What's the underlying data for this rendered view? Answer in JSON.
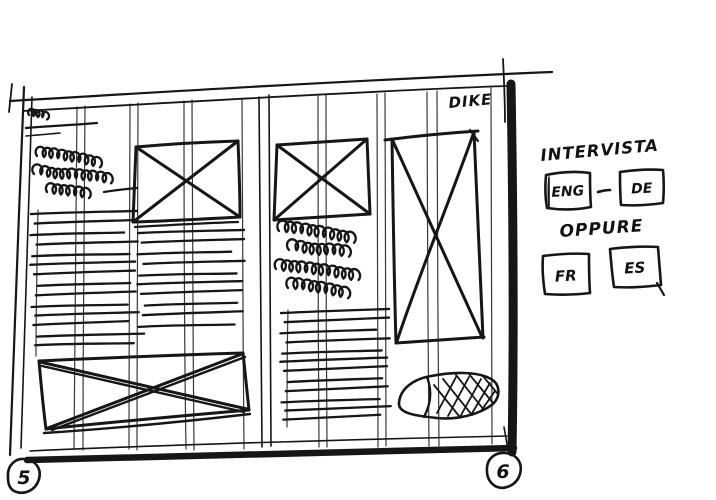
{
  "page": {
    "paper_color": "#ffffff",
    "ink_color": "#161616"
  },
  "spread": {
    "publication_title": "DIKE",
    "left_page_number": "5",
    "right_page_number": "6"
  },
  "margin_notes": {
    "title": "INTERVISTA",
    "language_pair_primary": {
      "first": "ENG",
      "separator": "-",
      "second": "DE"
    },
    "or_label": "OPPURE",
    "language_pair_alternate": {
      "first": "FR",
      "second": "ES"
    }
  },
  "placeholders": {
    "image_box": "x-crossed-rectangle",
    "text_block": "ruled-lines",
    "handwriting_block": "loop-scribble",
    "photo_blob": "crosshatched-oval"
  }
}
